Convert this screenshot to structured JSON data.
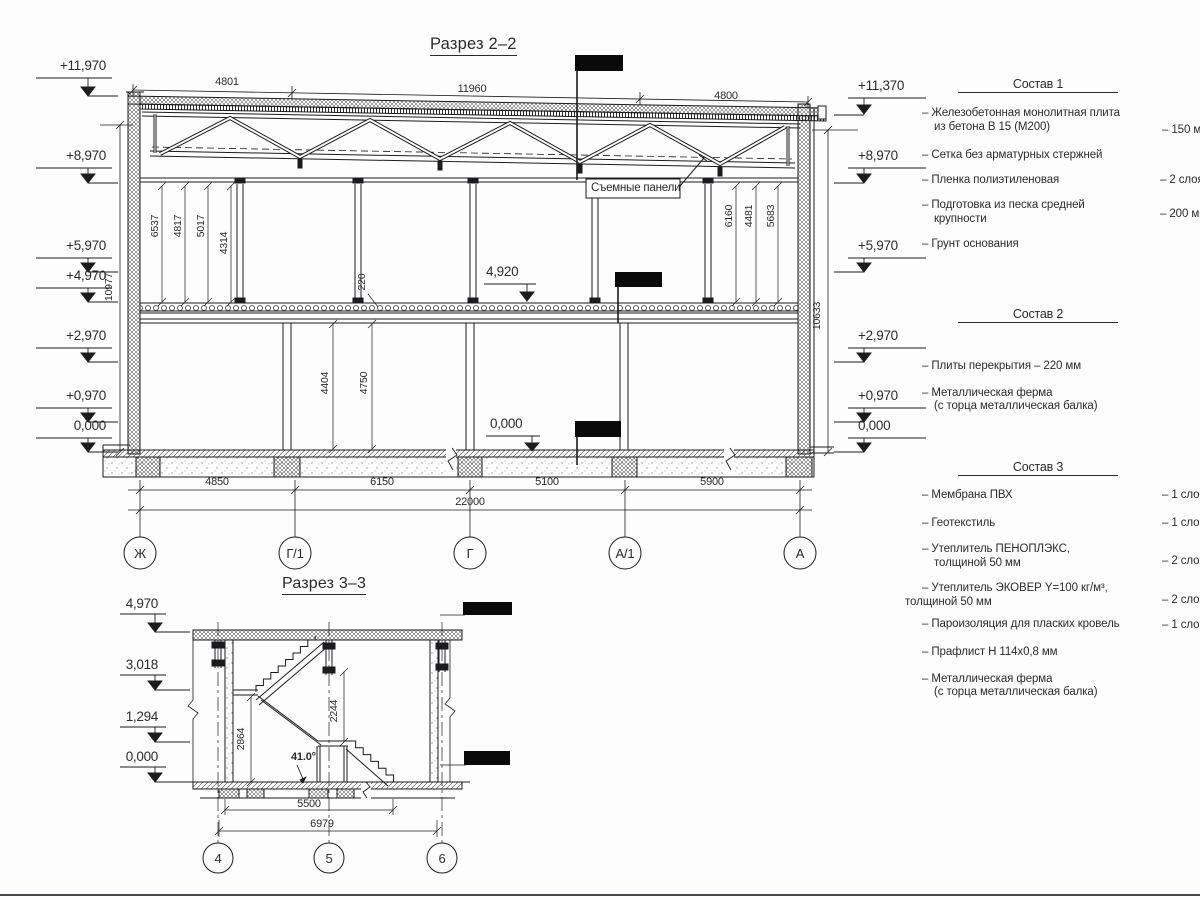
{
  "section2": {
    "title": "Разрез 2–2",
    "top_dims": [
      "4801",
      "11960",
      "4800"
    ],
    "left_elevations": [
      "+11,970",
      "+8,970",
      "+5,970",
      "+4,970",
      "+2,970",
      "+0,970",
      "0,000"
    ],
    "right_elevations": [
      "+11,370",
      "+8,970",
      "+5,970",
      "+2,970",
      "+0,970",
      "0,000"
    ],
    "overall_height_left": "10977",
    "overall_height_right": "10633",
    "upper_dims_left": [
      "6537",
      "4817",
      "5017",
      "4314"
    ],
    "upper_dims_right": [
      "6160",
      "4481",
      "5683"
    ],
    "slab_thickness": "220",
    "lower_dims": [
      "4404",
      "4750"
    ],
    "mid_elevation": "4,920",
    "floor_elevation": "0,000",
    "panels_label": "Съемные панели",
    "bottom_dims": [
      "4850",
      "6150",
      "5100",
      "5900"
    ],
    "total_dim": "22000",
    "axes": [
      "Ж",
      "Г/1",
      "Г",
      "А/1",
      "А"
    ]
  },
  "section3": {
    "title": "Разрез 3–3",
    "elevations": [
      "4,970",
      "3,018",
      "1,294",
      "0,000"
    ],
    "stair_height": "2864",
    "landing_height": "2244",
    "angle": "41.0°",
    "run": "5500",
    "total_run": "6979",
    "axes": [
      "4",
      "5",
      "6"
    ]
  },
  "compositions": [
    {
      "title": "Состав 1",
      "items": [
        {
          "lines": [
            "– Железобетонная  монолитная плита",
            "из бетона В 15 (М200)"
          ],
          "value": "– 150 мм"
        },
        {
          "lines": [
            "– Сетка без арматурных стержней"
          ],
          "value": ""
        },
        {
          "lines": [
            "– Пленка полиэтиленовая"
          ],
          "value": "–  2 слоя"
        },
        {
          "lines": [
            "– Подготовка из песка средней",
            "крупности"
          ],
          "value": "– 200 мм"
        },
        {
          "lines": [
            "– Грунт основания"
          ],
          "value": ""
        }
      ]
    },
    {
      "title": "Состав 2",
      "items": [
        {
          "lines": [
            "– Плиты перекрытия – 220 мм"
          ],
          "value": ""
        },
        {
          "lines": [
            "– Металлическая ферма",
            "(с торца металлическая балка)"
          ],
          "value": ""
        }
      ]
    },
    {
      "title": "Состав 3",
      "items": [
        {
          "lines": [
            "– Мембрана ПВХ"
          ],
          "value": "– 1 слой"
        },
        {
          "lines": [
            "– Геотекстиль"
          ],
          "value": "– 1 слой"
        },
        {
          "lines": [
            "– Утеплитель ПЕНОПЛЭКС,",
            "толщиной 50 мм"
          ],
          "value": "– 2 слоя"
        },
        {
          "lines": [
            "– Утеплитель ЭКОВЕР Y=100 кг/м³,",
            "толщиной 50 мм"
          ],
          "value": "– 2 слоя"
        },
        {
          "lines": [
            "– Пароизоляция для пласких кровель"
          ],
          "value": "– 1 слой"
        },
        {
          "lines": [
            "– Прафлист Н 114х0,8 мм"
          ],
          "value": ""
        },
        {
          "lines": [
            "– Металлическая ферма",
            "(с торца металлическая балка)"
          ],
          "value": ""
        }
      ]
    }
  ]
}
